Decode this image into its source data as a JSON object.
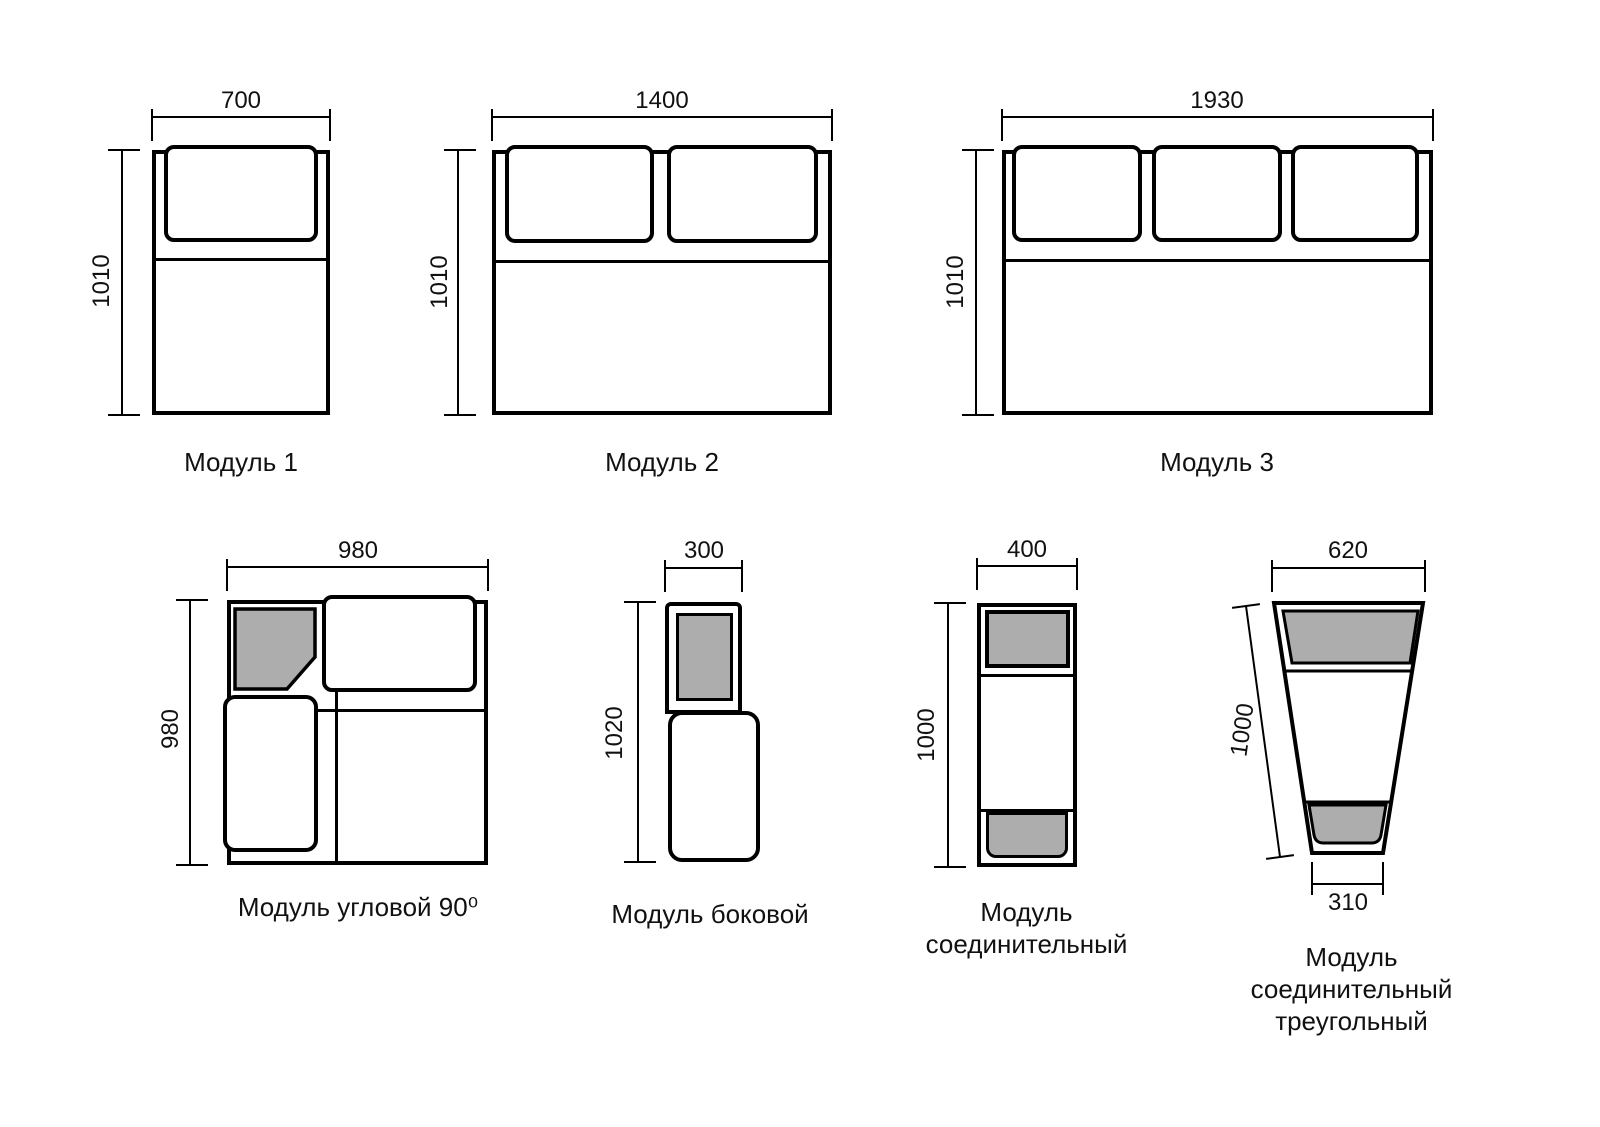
{
  "diagram": {
    "background": "#ffffff",
    "line_color": "#000000",
    "pad_fill": "#adadad"
  },
  "modules": {
    "m1": {
      "label": "Модуль 1",
      "width": "700",
      "height": "1010"
    },
    "m2": {
      "label": "Модуль 2",
      "width": "1400",
      "height": "1010"
    },
    "m3": {
      "label": "Модуль 3",
      "width": "1930",
      "height": "1010"
    },
    "corner": {
      "label": "Модуль угловой 90⁰",
      "width": "980",
      "height": "980"
    },
    "side": {
      "label": "Модуль боковой",
      "width": "300",
      "height": "1020"
    },
    "connector": {
      "label": "Модуль соединительный",
      "width": "400",
      "height": "1000"
    },
    "triangle": {
      "label": "Модуль соединительный треугольный",
      "width": "620",
      "height": "1000",
      "bottom_width": "310"
    }
  }
}
